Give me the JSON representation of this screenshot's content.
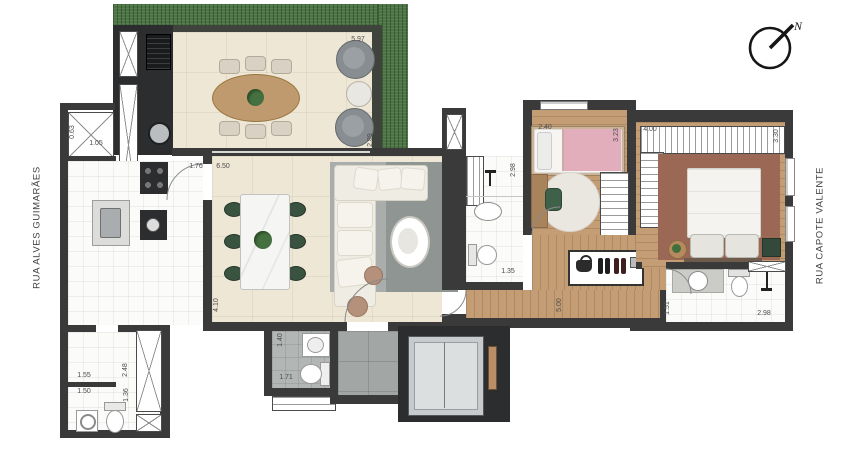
{
  "compass": {
    "north": "N"
  },
  "streets": {
    "left": "RUA ALVES GUIMARÃES",
    "right": "RUA CAPOTE VALENTE"
  },
  "dimensions": {
    "balcony_width": "5.97",
    "balcony_depth": "2.89",
    "kitchen_nook_depth": "0.63",
    "kitchen_nook_width": "1.05",
    "kitchen_width": "1.76",
    "living_width": "6.50",
    "living_depth": "4.10",
    "laundry_width": "1.55",
    "wc_width": "1.50",
    "laundry_depth": "2.48",
    "wc_depth": "1.36",
    "lavabo_depth": "1.40",
    "lavabo_width": "1.71",
    "bedroom2_width": "2.40",
    "bedroom2_depth": "3.23",
    "bath_social_depth": "2.98",
    "bath_social_width": "1.35",
    "hall_depth": "5.00",
    "suite_width": "4.00",
    "suite_depth": "3.30",
    "bath_suite_depth": "1.51",
    "bath_suite_width": "2.98"
  },
  "colors": {
    "wall": "#3a3a3a",
    "grass": "#4c7444",
    "floor_beige": "#efe7d5",
    "floor_white": "#fbfbfa",
    "tile_gray": "#b2b6b4",
    "hall_gray": "#a2a7a5",
    "wood": "#c59d74",
    "rug_gray": "#a9aeac",
    "rug_gray_dark": "#8f9593",
    "rug_maroon": "#9a6854",
    "counter_dark": "#2b2d2f",
    "sofa_cream": "#efece3",
    "chair_green": "#3a5341",
    "bed_pink": "#e3aebb",
    "marble_white": "#f5f5f3",
    "armchair_gray": "#878d90"
  }
}
